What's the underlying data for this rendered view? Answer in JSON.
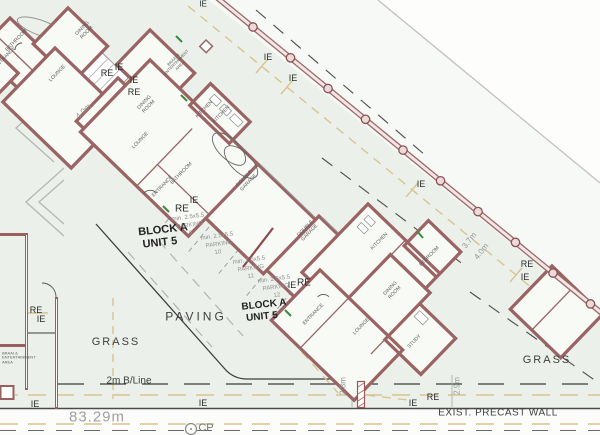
{
  "drawing": {
    "type": "architectural site plan",
    "colors": {
      "wall": "#9b6464",
      "boundary_wall": "#9d6868",
      "sewer_line": "#d8c48f",
      "site_tint": "#ebf1ea",
      "dim_gray": "#949494",
      "door_green": "#3f8a3f"
    }
  },
  "labels": [
    {
      "name": "marker-ie",
      "text": "IE",
      "x": 203,
      "y": 5,
      "s": 8,
      "c": "#2b2b2b"
    },
    {
      "name": "marker-re",
      "text": "RE",
      "x": 107,
      "y": 73,
      "s": 9,
      "c": "#2b2b2b"
    },
    {
      "name": "marker-ie",
      "text": "IE",
      "x": 119,
      "y": 67,
      "s": 9,
      "c": "#2b2b2b"
    },
    {
      "name": "marker-ie",
      "text": "IE",
      "x": 134,
      "y": 80,
      "s": 9,
      "c": "#2b2b2b"
    },
    {
      "name": "marker-re",
      "text": "RE",
      "x": 134,
      "y": 92,
      "s": 9,
      "c": "#2b2b2b"
    },
    {
      "name": "marker-ie",
      "text": "IE",
      "x": 268,
      "y": 57,
      "s": 9,
      "c": "#2b2b2b"
    },
    {
      "name": "marker-ie",
      "text": "IE",
      "x": 293,
      "y": 78,
      "s": 9,
      "c": "#2b2b2b"
    },
    {
      "name": "marker-ie",
      "text": "IE",
      "x": 194,
      "y": 200,
      "s": 9,
      "c": "#2b2b2b"
    },
    {
      "name": "marker-re",
      "text": "RE",
      "x": 182,
      "y": 209,
      "s": 10,
      "c": "#2b2b2b"
    },
    {
      "name": "marker-ie",
      "text": "IE",
      "x": 292,
      "y": 285,
      "s": 9,
      "c": "#2b2b2b"
    },
    {
      "name": "marker-re",
      "text": "RE",
      "x": 304,
      "y": 283,
      "s": 10,
      "c": "#2b2b2b"
    },
    {
      "name": "marker-ie",
      "text": "IE",
      "x": 421,
      "y": 184,
      "s": 9,
      "c": "#2b2b2b"
    },
    {
      "name": "marker-re",
      "text": "RE",
      "x": 527,
      "y": 264,
      "s": 9,
      "c": "#2b2b2b"
    },
    {
      "name": "marker-ie",
      "text": "IE",
      "x": 525,
      "y": 277,
      "s": 9,
      "c": "#2b2b2b"
    },
    {
      "name": "marker-re",
      "text": "RE",
      "x": 36,
      "y": 310,
      "s": 9,
      "c": "#2b2b2b"
    },
    {
      "name": "marker-ie",
      "text": "IE",
      "x": 41,
      "y": 319,
      "s": 9,
      "c": "#2b2b2b"
    },
    {
      "name": "marker-ie",
      "text": "IE",
      "x": 35,
      "y": 404,
      "s": 9,
      "c": "#2b2b2b"
    },
    {
      "name": "marker-ie",
      "text": "IE",
      "x": 203,
      "y": 403,
      "s": 9,
      "c": "#2b2b2b"
    },
    {
      "name": "marker-ie",
      "text": "IE",
      "x": 413,
      "y": 403,
      "s": 9,
      "c": "#2b2b2b"
    },
    {
      "name": "marker-re",
      "text": "RE",
      "x": 433,
      "y": 397,
      "s": 9,
      "c": "#2b2b2b"
    },
    {
      "name": "dim-4-0m",
      "text": "4.0m",
      "x": 84,
      "y": 112,
      "r": -44,
      "s": 8,
      "c": "#949494"
    },
    {
      "name": "dim-3-7m",
      "text": "3.7m",
      "x": 470,
      "y": 241,
      "r": -52,
      "s": 8,
      "c": "#949494"
    },
    {
      "name": "dim-4-0m",
      "text": "4.0m",
      "x": 482,
      "y": 252,
      "r": -52,
      "s": 8,
      "c": "#949494"
    },
    {
      "name": "dim-2-8m",
      "text": "2.8m",
      "x": 344,
      "y": 386,
      "r": -90,
      "s": 8,
      "c": "#949494"
    },
    {
      "name": "dim-2-9m",
      "text": "2.9m",
      "x": 458,
      "y": 386,
      "r": -90,
      "s": 8,
      "c": "#949494"
    },
    {
      "name": "dim-2m-building-line",
      "text": "2m B/Line",
      "x": 129,
      "y": 381,
      "s": 10,
      "c": "#3a3a3a"
    },
    {
      "name": "dim-83-29m",
      "text": "83.29m",
      "x": 97,
      "y": 418,
      "s": 15,
      "c": "#a0a0a0",
      "sp": 1
    },
    {
      "name": "label-grass",
      "text": "GRASS",
      "x": 116,
      "y": 342,
      "s": 11,
      "sp": 2
    },
    {
      "name": "label-grass",
      "text": "GRASS",
      "x": 547,
      "y": 360,
      "s": 11,
      "sp": 2
    },
    {
      "name": "label-paving",
      "text": "PAVING",
      "x": 196,
      "y": 317,
      "s": 12,
      "sp": 3
    },
    {
      "name": "label-exist-precast-wall",
      "text": "EXIST. PRECAST WALL",
      "x": 498,
      "y": 413,
      "s": 10,
      "sp": 0.5
    },
    {
      "name": "label-cp",
      "text": "CP",
      "x": 206,
      "y": 428,
      "s": 11,
      "c": "#757575"
    },
    {
      "name": "label-block-a",
      "text": "BLOCK A",
      "x": 163,
      "y": 230,
      "s": 11,
      "w": 700,
      "r": -6,
      "c": "#222"
    },
    {
      "name": "label-unit-5",
      "text": "UNIT 5",
      "x": 160,
      "y": 243,
      "s": 11,
      "w": 700,
      "r": -6,
      "c": "#222"
    },
    {
      "name": "label-block-a",
      "text": "BLOCK A",
      "x": 264,
      "y": 305,
      "s": 10,
      "w": 700,
      "r": -6,
      "c": "#222"
    },
    {
      "name": "label-unit-5",
      "text": "UNIT 5",
      "x": 262,
      "y": 317,
      "s": 10,
      "w": 700,
      "r": -6,
      "c": "#222"
    },
    {
      "name": "parking-min-dim",
      "text": "min. 2.5x5.5",
      "x": 188,
      "y": 218,
      "s": 6,
      "r": -8,
      "c": "#909090"
    },
    {
      "name": "parking-label",
      "text": "PARKING",
      "x": 190,
      "y": 226,
      "s": 6,
      "r": -8,
      "c": "#909090"
    },
    {
      "name": "parking-number",
      "text": "9",
      "x": 191,
      "y": 234,
      "s": 6,
      "r": -8,
      "c": "#909090"
    },
    {
      "name": "parking-min-dim",
      "text": "min. 2.5x5.5",
      "x": 217,
      "y": 237,
      "s": 6,
      "r": -8,
      "c": "#909090"
    },
    {
      "name": "parking-label",
      "text": "PARKING",
      "x": 219,
      "y": 245,
      "s": 6,
      "r": -8,
      "c": "#909090"
    },
    {
      "name": "parking-number",
      "text": "10",
      "x": 218,
      "y": 253,
      "s": 6,
      "r": -8,
      "c": "#909090"
    },
    {
      "name": "parking-min-dim",
      "text": "min. 2.5x5.5",
      "x": 249,
      "y": 261,
      "s": 6,
      "r": -8,
      "c": "#909090"
    },
    {
      "name": "parking-label",
      "text": "PARKING",
      "x": 251,
      "y": 269,
      "s": 6,
      "r": -8,
      "c": "#909090"
    },
    {
      "name": "parking-number",
      "text": "11",
      "x": 251,
      "y": 277,
      "s": 6,
      "r": -8,
      "c": "#909090"
    },
    {
      "name": "parking-min-dim",
      "text": "min. 2.5x5.5",
      "x": 274,
      "y": 280,
      "s": 6,
      "r": -8,
      "c": "#909090"
    },
    {
      "name": "parking-label",
      "text": "PARKING",
      "x": 276,
      "y": 288,
      "s": 6,
      "r": -8,
      "c": "#909090"
    },
    {
      "name": "parking-number",
      "text": "12",
      "x": 277,
      "y": 296,
      "s": 6,
      "r": -8,
      "c": "#909090"
    },
    {
      "name": "room-label-bathroom",
      "text": "BATHROOM",
      "x": 17,
      "y": 41,
      "s": 5,
      "r": -46,
      "c": "#5f5f5f"
    },
    {
      "name": "room-label-entrance",
      "text": "ENTRANCE",
      "x": 6,
      "y": 58,
      "s": 5,
      "r": -46,
      "c": "#5f5f5f"
    },
    {
      "name": "room-label-lounge",
      "text": "LOUNGE",
      "x": 58,
      "y": 74,
      "s": 5,
      "r": -46,
      "c": "#5f5f5f"
    },
    {
      "name": "room-label-dining-room",
      "text": "DINING\nROOM",
      "x": 85,
      "y": 31,
      "s": 5,
      "r": -46,
      "c": "#5f5f5f"
    },
    {
      "name": "room-label-braai-entertainment",
      "text": "BRAAI &\nENTERTAINMENT\nAREA",
      "x": 177,
      "y": 63,
      "s": 4,
      "r": -46,
      "c": "#5f5f5f"
    },
    {
      "name": "room-label-dining-room",
      "text": "DINING\nROOM",
      "x": 147,
      "y": 105,
      "s": 5,
      "r": -46,
      "c": "#5f5f5f"
    },
    {
      "name": "room-label-kitchen",
      "text": "KITCHEN",
      "x": 205,
      "y": 110,
      "s": 5,
      "r": -46,
      "c": "#5f5f5f"
    },
    {
      "name": "room-label-lounge",
      "text": "LOUNGE",
      "x": 141,
      "y": 141,
      "s": 5,
      "r": -46,
      "c": "#5f5f5f"
    },
    {
      "name": "room-label-kitchen",
      "text": "KITCHEN",
      "x": 222,
      "y": 115,
      "s": 5,
      "r": -46,
      "c": "#5f5f5f"
    },
    {
      "name": "room-label-bathroom",
      "text": "BATHROOM",
      "x": 182,
      "y": 174,
      "s": 5,
      "r": -46,
      "c": "#5f5f5f"
    },
    {
      "name": "room-label-entrance",
      "text": "ENTRANCE",
      "x": 163,
      "y": 187,
      "s": 5,
      "r": -46,
      "c": "#5f5f5f"
    },
    {
      "name": "room-label-double-garage",
      "text": "DOUBLE\nGARAGE",
      "x": 247,
      "y": 181,
      "s": 5,
      "r": -46,
      "c": "#5f5f5f"
    },
    {
      "name": "room-label-double-garage",
      "text": "DOUBLE\nGARAGE",
      "x": 308,
      "y": 231,
      "s": 5,
      "r": -46,
      "c": "#5f5f5f"
    },
    {
      "name": "room-label-kitchen",
      "text": "KITCHEN",
      "x": 380,
      "y": 242,
      "s": 5,
      "r": -46,
      "c": "#5f5f5f"
    },
    {
      "name": "room-label-bedroom",
      "text": "BEDROOM",
      "x": 430,
      "y": 257,
      "s": 5,
      "r": -46,
      "c": "#5f5f5f"
    },
    {
      "name": "room-label-dining-room",
      "text": "DINING\nROOM",
      "x": 393,
      "y": 291,
      "s": 5,
      "r": -46,
      "c": "#5f5f5f"
    },
    {
      "name": "room-label-entrance",
      "text": "ENTRANCE",
      "x": 314,
      "y": 315,
      "s": 5,
      "r": -46,
      "c": "#5f5f5f"
    },
    {
      "name": "room-label-lounge",
      "text": "LOUNGE",
      "x": 362,
      "y": 327,
      "s": 5,
      "r": -46,
      "c": "#5f5f5f"
    },
    {
      "name": "room-label-study",
      "text": "STUDY",
      "x": 415,
      "y": 342,
      "s": 5,
      "r": -46,
      "c": "#5f5f5f"
    },
    {
      "name": "room-label-braai-entertainment",
      "text": "BRAAI &\nENTERTAINMENT\nAREA",
      "x": 2,
      "y": 358,
      "s": 4,
      "r": 0,
      "a": "l",
      "c": "#5f5f5f"
    }
  ]
}
